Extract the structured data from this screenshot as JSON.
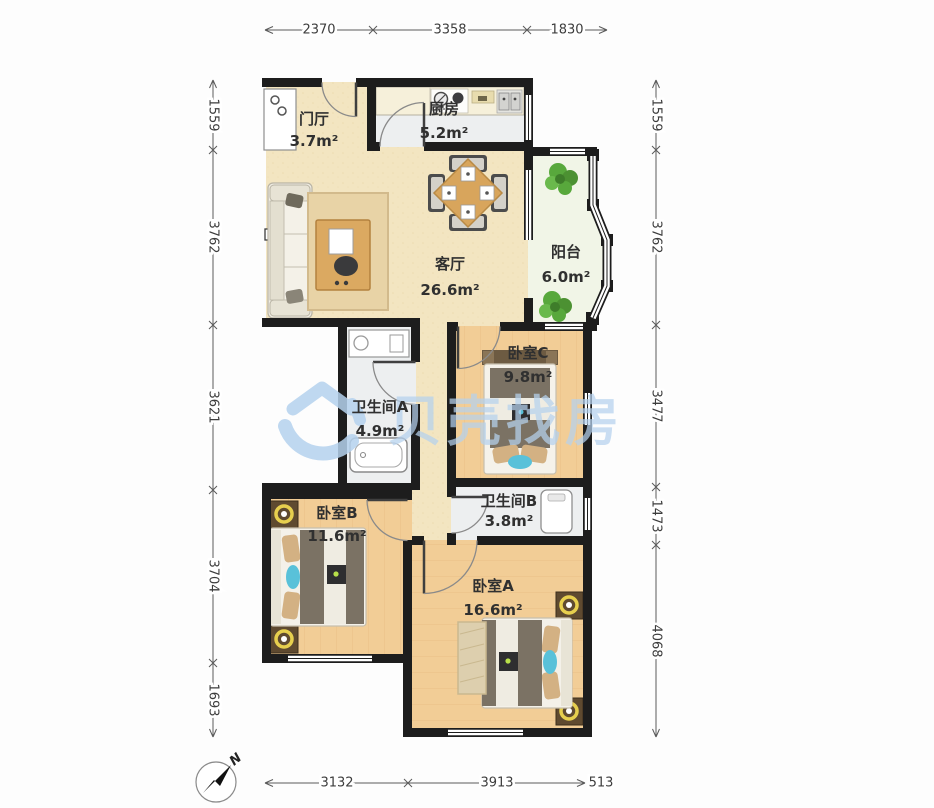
{
  "plan": {
    "title": "apartment-floorplan",
    "rooms": [
      {
        "id": "entry",
        "name": "门厅",
        "area": "3.7m²"
      },
      {
        "id": "kitchen",
        "name": "厨房",
        "area": "5.2m²"
      },
      {
        "id": "living",
        "name": "客厅",
        "area": "26.6m²"
      },
      {
        "id": "balcony",
        "name": "阳台",
        "area": "6.0m²"
      },
      {
        "id": "bedroomC",
        "name": "卧室C",
        "area": "9.8m²"
      },
      {
        "id": "bathA",
        "name": "卫生间A",
        "area": "4.9m²"
      },
      {
        "id": "bathB",
        "name": "卫生间B",
        "area": "3.8m²"
      },
      {
        "id": "bedroomB",
        "name": "卧室B",
        "area": "11.6m²"
      },
      {
        "id": "bedroomA",
        "name": "卧室A",
        "area": "16.6m²"
      }
    ],
    "dimensions": {
      "top": [
        "2370",
        "3358",
        "1830"
      ],
      "bottom": [
        "3132",
        "3913",
        "513"
      ],
      "left": [
        "1559",
        "3762",
        "3621",
        "3704",
        "1693"
      ],
      "right": [
        "1559",
        "3762",
        "3477",
        "1473",
        "4068"
      ]
    },
    "compass": {
      "label": "N"
    },
    "watermark": {
      "text": "贝壳找房"
    },
    "colors": {
      "wall": "#1d1d1d",
      "floor_living": "#f3e5c1",
      "floor_wood": "#f2cd96",
      "floor_wet": "#edeff0",
      "floor_balcony": "#f1f5e7",
      "watermark_blue": "#b5d2ee",
      "plant_green": "#58a83c",
      "duvet": "#7b7264",
      "pillow_tan": "#d3b183",
      "accent_teal": "#59c1d9",
      "lamp_ring": "#e7cf4e",
      "table_wood": "#d8a55c"
    }
  }
}
